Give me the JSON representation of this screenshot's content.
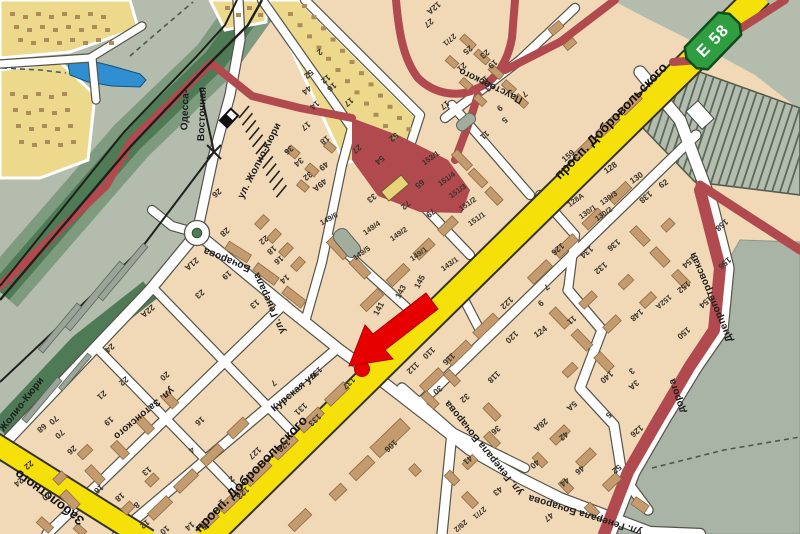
{
  "map": {
    "colors": {
      "open_land": "#b4bcae",
      "residential": "#f1d8b6",
      "building": "#c49b6e",
      "building_outline": "#8d6b43",
      "garage_block": "#ecd98c",
      "garage_dot": "#ad8c5c",
      "main_road_yellow": "#f6e00a",
      "road_white": "#ffffff",
      "road_casing": "#55534a",
      "boundary_red": "#b14a4f",
      "marker_red": "#e60000",
      "rail_green_dark": "#4e7a55",
      "rail_green_mid": "#7e9b80",
      "pond_blue": "#2f8fd0",
      "badge_green": "#2f9e41",
      "platform_gray": "#9aa499"
    },
    "highway_badge": {
      "code": "Е 58"
    },
    "marker": {
      "color": "#e60000",
      "dot_x": 362,
      "dot_y": 369,
      "arrow_tip_x": 349,
      "arrow_tip_y": 366
    },
    "street_labels": [
      {
        "t": "просп. Добровольского",
        "x": 614,
        "y": 124,
        "r": -46,
        "k": "road"
      },
      {
        "t": "просп. Добровольского",
        "x": 254,
        "y": 477,
        "r": -46,
        "k": "road"
      },
      {
        "t": "Заболотного",
        "x": 52,
        "y": 494,
        "r": 217,
        "k": "road"
      },
      {
        "t": "Курская ул.",
        "x": 297,
        "y": 393,
        "r": -40,
        "k": "st"
      },
      {
        "t": "ул. Затонского",
        "x": 142,
        "y": 411,
        "r": 140,
        "k": "st"
      },
      {
        "t": "Бочарова",
        "x": 228,
        "y": 257,
        "r": 202,
        "k": "st"
      },
      {
        "t": "ул. Генерала",
        "x": 272,
        "y": 302,
        "r": 246,
        "k": "st"
      },
      {
        "t": "ул. Генерала Бочарова",
        "x": 486,
        "y": 446,
        "r": 231,
        "k": "st"
      },
      {
        "t": "ул. Генерала Бочарова",
        "x": 586,
        "y": 512,
        "r": 197,
        "k": "st"
      },
      {
        "t": "ул. Жолио-Кюри",
        "x": 262,
        "y": 162,
        "r": -63,
        "k": "st"
      },
      {
        "t": "Жолио-Кюри",
        "x": 24,
        "y": 406,
        "r": -52,
        "k": "st"
      },
      {
        "t": "Одесса-",
        "x": 188,
        "y": 110,
        "r": -88,
        "k": "st"
      },
      {
        "t": "Восточная",
        "x": 205,
        "y": 114,
        "r": -88,
        "k": "st"
      },
      {
        "t": "Паустовского",
        "x": 492,
        "y": 83,
        "r": 206,
        "k": "st"
      },
      {
        "t": "Днепропетровская",
        "x": 714,
        "y": 296,
        "r": 247,
        "k": "st"
      },
      {
        "t": "дорога",
        "x": 680,
        "y": 395,
        "r": 252,
        "k": "st"
      }
    ],
    "house_numbers": [
      [
        "123",
        241,
        491,
        137
      ],
      [
        "127",
        253,
        451,
        137
      ],
      [
        "129",
        282,
        444,
        137
      ],
      [
        "131",
        299,
        407,
        137
      ],
      [
        "133",
        313,
        418,
        137
      ],
      [
        "137",
        347,
        381,
        137
      ],
      [
        "139",
        314,
        371,
        137
      ],
      [
        "141",
        381,
        310,
        -62
      ],
      [
        "143",
        403,
        293,
        -62
      ],
      [
        "145",
        422,
        283,
        -62
      ],
      [
        "149/1",
        420,
        256,
        -35
      ],
      [
        "149/2",
        400,
        236,
        -35
      ],
      [
        "149/4",
        373,
        230,
        -35
      ],
      [
        "149/5",
        363,
        255,
        -35
      ],
      [
        "149/6",
        330,
        221,
        -28
      ],
      [
        "143/1",
        451,
        266,
        -35
      ],
      [
        "151/1",
        478,
        221,
        -35
      ],
      [
        "151/2",
        469,
        206,
        -35
      ],
      [
        "151/3",
        459,
        193,
        -35
      ],
      [
        "151/4",
        448,
        181,
        -35
      ],
      [
        "153/1",
        432,
        160,
        -35
      ],
      [
        "159",
        570,
        158,
        -40
      ],
      [
        "33",
        370,
        196,
        140
      ],
      [
        "72",
        404,
        203,
        140
      ],
      [
        "79",
        429,
        211,
        140
      ],
      [
        "65",
        418,
        182,
        140
      ],
      [
        "12А",
        432,
        6,
        140
      ],
      [
        "27",
        427,
        21,
        140
      ],
      [
        "27/1",
        448,
        38,
        140
      ],
      [
        "25",
        466,
        48,
        140
      ],
      [
        "23",
        483,
        52,
        140
      ],
      [
        "21",
        460,
        65,
        140
      ],
      [
        "19",
        491,
        62,
        140
      ],
      [
        "17",
        443,
        103,
        140
      ],
      [
        "15",
        482,
        78,
        140
      ],
      [
        "13",
        488,
        85,
        140
      ],
      [
        "11",
        483,
        133,
        140
      ],
      [
        "9",
        498,
        106,
        140
      ],
      [
        "7",
        523,
        92,
        140
      ],
      [
        "5",
        503,
        118,
        140
      ],
      [
        "2",
        318,
        50,
        140
      ],
      [
        "52",
        307,
        72,
        140
      ],
      [
        "12",
        324,
        77,
        140
      ],
      [
        "16",
        330,
        85,
        140
      ],
      [
        "44",
        305,
        88,
        140
      ],
      [
        "14",
        313,
        103,
        140
      ],
      [
        "17",
        347,
        100,
        140
      ],
      [
        "52",
        392,
        135,
        140
      ],
      [
        "54",
        378,
        158,
        140
      ],
      [
        "27",
        355,
        147,
        140
      ],
      [
        "18",
        323,
        138,
        140
      ],
      [
        "17",
        304,
        124,
        140
      ],
      [
        "36",
        287,
        148,
        140
      ],
      [
        "34",
        297,
        160,
        140
      ],
      [
        "49",
        322,
        164,
        140
      ],
      [
        "32",
        306,
        174,
        140
      ],
      [
        "49А",
        318,
        183,
        140
      ],
      [
        "26",
        215,
        191,
        140
      ],
      [
        "28",
        223,
        230,
        140
      ],
      [
        "21А",
        190,
        262,
        140
      ],
      [
        "19",
        225,
        273,
        140
      ],
      [
        "23",
        198,
        292,
        140
      ],
      [
        "13",
        253,
        302,
        140
      ],
      [
        "22",
        262,
        238,
        140
      ],
      [
        "18",
        270,
        248,
        140
      ],
      [
        "16",
        277,
        258,
        140
      ],
      [
        "14",
        283,
        277,
        140
      ],
      [
        "22А",
        146,
        309,
        140
      ],
      [
        "24",
        108,
        346,
        140
      ],
      [
        "22",
        122,
        379,
        140
      ],
      [
        "21",
        100,
        393,
        140
      ],
      [
        "20",
        163,
        374,
        140
      ],
      [
        "19",
        107,
        419,
        140
      ],
      [
        "26",
        70,
        448,
        140
      ],
      [
        "16",
        198,
        419,
        140
      ],
      [
        "16",
        97,
        487,
        140
      ],
      [
        "13",
        145,
        469,
        140
      ],
      [
        "8",
        135,
        503,
        140
      ],
      [
        "18",
        118,
        495,
        140
      ],
      [
        "12",
        143,
        522,
        140
      ],
      [
        "10",
        163,
        528,
        140
      ],
      [
        "14",
        188,
        524,
        140
      ],
      [
        "24",
        17,
        480,
        140
      ],
      [
        "22",
        27,
        463,
        140
      ],
      [
        "20",
        45,
        494,
        140
      ],
      [
        "68",
        40,
        426,
        140
      ],
      [
        "70",
        52,
        418,
        140
      ],
      [
        "70",
        58,
        432,
        140
      ],
      [
        "4",
        190,
        448,
        140
      ],
      [
        "2",
        230,
        477,
        140
      ],
      [
        "1",
        220,
        500,
        140
      ],
      [
        "5",
        202,
        525,
        140
      ],
      [
        "7",
        272,
        381,
        140
      ],
      [
        "106",
        389,
        444,
        137
      ],
      [
        "110",
        427,
        351,
        137
      ],
      [
        "112",
        411,
        366,
        137
      ],
      [
        "116",
        447,
        357,
        137
      ],
      [
        "118",
        492,
        375,
        137
      ],
      [
        "120",
        510,
        335,
        137
      ],
      [
        "122",
        505,
        301,
        137
      ],
      [
        "30",
        436,
        388,
        140
      ],
      [
        "32",
        463,
        396,
        140
      ],
      [
        "36",
        494,
        428,
        140
      ],
      [
        "41",
        466,
        458,
        140
      ],
      [
        "43",
        496,
        489,
        140
      ],
      [
        "27/1",
        478,
        511,
        140
      ],
      [
        "29/2",
        459,
        524,
        140
      ],
      [
        "124",
        542,
        334,
        -35
      ],
      [
        "9",
        539,
        301,
        140
      ],
      [
        "7",
        545,
        285,
        140
      ],
      [
        "11",
        570,
        318,
        140
      ],
      [
        "140",
        605,
        375,
        140
      ],
      [
        "3",
        630,
        369,
        140
      ],
      [
        "3А",
        632,
        383,
        140
      ],
      [
        "5",
        607,
        413,
        140
      ],
      [
        "5А",
        570,
        404,
        140
      ],
      [
        "148",
        635,
        313,
        140
      ],
      [
        "150",
        682,
        331,
        140
      ],
      [
        "152",
        682,
        285,
        140
      ],
      [
        "152А",
        662,
        300,
        140
      ],
      [
        "154",
        687,
        260,
        140
      ],
      [
        "154",
        704,
        300,
        140
      ],
      [
        "156",
        723,
        261,
        140
      ],
      [
        "158",
        720,
        223,
        140
      ],
      [
        "126",
        556,
        247,
        140
      ],
      [
        "128А",
        577,
        202,
        -35
      ],
      [
        "128",
        612,
        170,
        -35
      ],
      [
        "130/1",
        589,
        214,
        -35
      ],
      [
        "130/2",
        605,
        216,
        -35
      ],
      [
        "130/3",
        610,
        200,
        -35
      ],
      [
        "130",
        638,
        180,
        -35
      ],
      [
        "132",
        599,
        266,
        140
      ],
      [
        "134",
        585,
        250,
        140
      ],
      [
        "136",
        612,
        243,
        140
      ],
      [
        "138",
        644,
        195,
        140
      ],
      [
        "62",
        665,
        186,
        -35
      ],
      [
        "28А",
        539,
        423,
        140
      ],
      [
        "42",
        562,
        434,
        140
      ],
      [
        "40",
        533,
        462,
        140
      ],
      [
        "44",
        563,
        480,
        140
      ],
      [
        "46",
        578,
        468,
        140
      ],
      [
        "52",
        615,
        467,
        140
      ],
      [
        "126",
        635,
        429,
        140
      ],
      [
        "47",
        547,
        515,
        140
      ]
    ]
  }
}
